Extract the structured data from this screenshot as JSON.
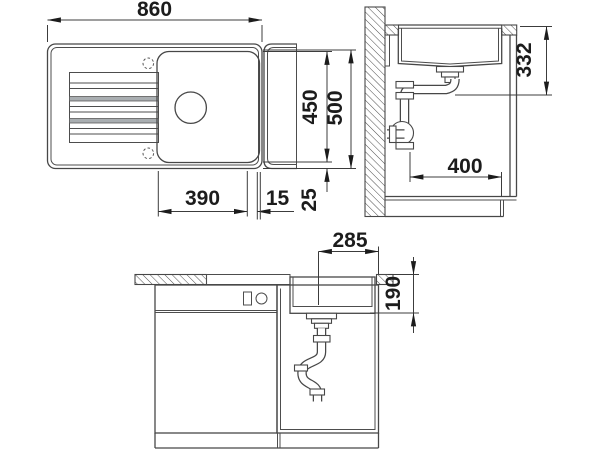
{
  "drawing": {
    "kind": "sink-installation-technical-drawing",
    "background": "#ffffff",
    "line_color": "#474747",
    "text_color": "#1c1c1c",
    "groove_fill": "#a9aeb1"
  },
  "dims": {
    "overall_width": "860",
    "bowl_length": "390",
    "rim_width": "15",
    "inner_depth": "450",
    "overall_depth": "500",
    "edge_margin": "25",
    "outlet_height": "332",
    "cabinet_depth": "400",
    "drain_to_edge": "285",
    "bowl_depth": "190"
  }
}
